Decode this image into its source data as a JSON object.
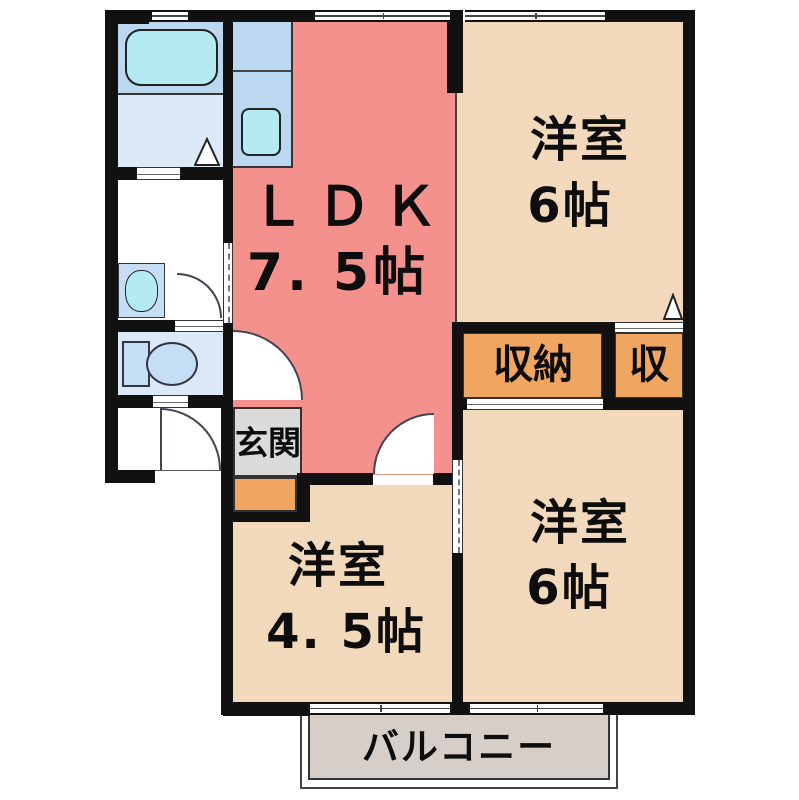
{
  "plan_title": "2LDK apartment floor plan",
  "rooms": {
    "ldk": {
      "name": "ＬＤＫ",
      "size": "7. 5帖"
    },
    "bedroom_top_right": {
      "name": "洋室",
      "size": "6帖"
    },
    "bedroom_bottom_right": {
      "name": "洋室",
      "size": "6帖"
    },
    "bedroom_bottom_left": {
      "name": "洋室",
      "size": "4. 5帖"
    },
    "closet_main": {
      "name": "収納"
    },
    "closet_small": {
      "name": "収"
    },
    "entrance": {
      "name": "玄関"
    },
    "balcony": {
      "name": "バルコニー"
    }
  },
  "fixtures": {
    "bathtub": "bathtub",
    "kitchen_sink": "kitchen-sink",
    "washbasin": "washbasin",
    "toilet": "toilet"
  },
  "colors": {
    "wall": "#111111",
    "line": "#333333",
    "ldk": "#f4918d",
    "bedroom": "#f3d9bc",
    "closet": "#f0a660",
    "counter": "#bcd8f0",
    "washroom": "#dceaf8",
    "toiletroom": "#dae8f7",
    "fixture": "#b4ebf3",
    "fixlight": "#c6def5",
    "genkan": "#dbdbdb",
    "balcony": "#d6cfc9",
    "background": "#ffffff"
  }
}
